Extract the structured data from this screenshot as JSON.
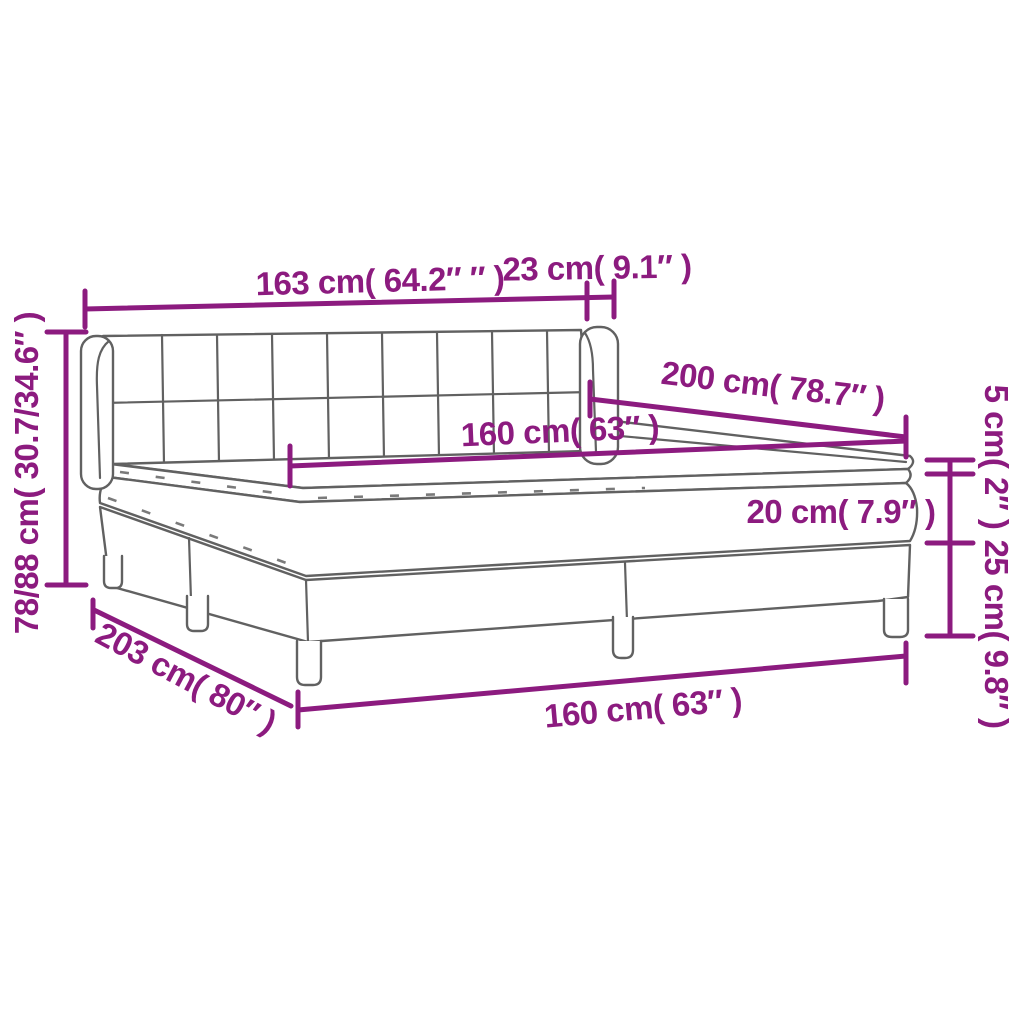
{
  "page": {
    "background": "#ffffff"
  },
  "diagram": {
    "title": "Box spring bed with tufted headboard — dimension diagram",
    "colors": {
      "dimension_accent": "#8c1b7f",
      "artwork_line": "#616161"
    },
    "labels": {
      "headboard_width": "163 cm( 64.2″ ″ )",
      "headboard_side": "23 cm( 9.1″ )",
      "total_height": "78/88 cm( 30.7/34.6″ )",
      "mattress_width_top": "160 cm( 63″ )",
      "bed_length": "200 cm( 78.7″ )",
      "topper_height": "5 cm( 2″ )",
      "mattress_height": "20 cm( 7.9″ )",
      "base_height": "25 cm( 9.8″ )",
      "total_length": "203 cm( 80″ )",
      "mattress_width_bottom": "160 cm( 63″ )"
    }
  }
}
